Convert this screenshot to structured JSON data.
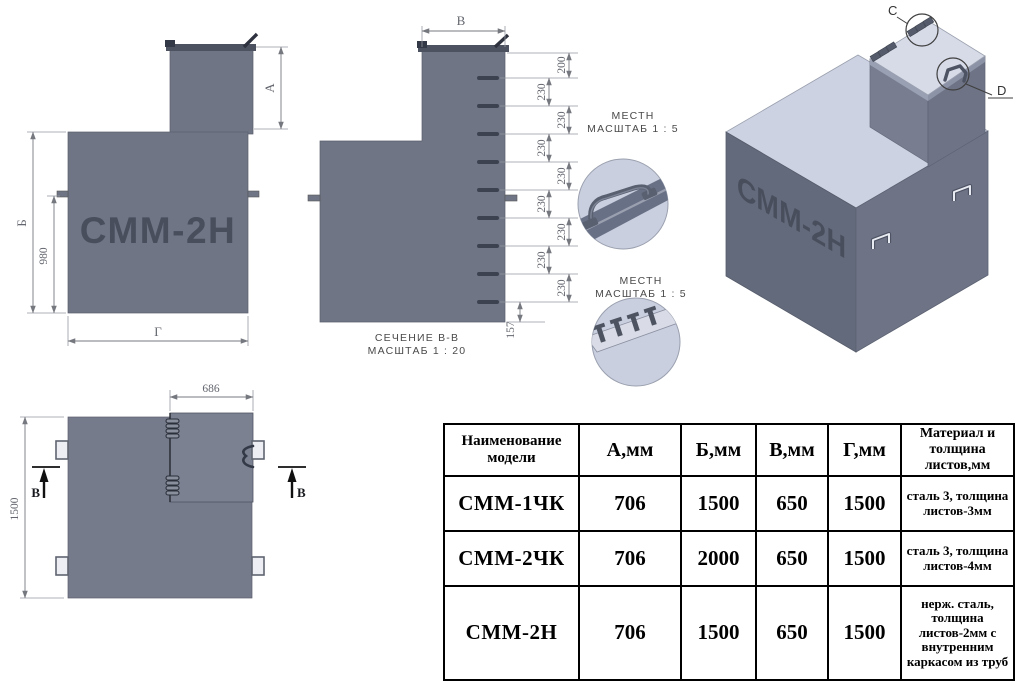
{
  "title": "СММ-2Н technical drawing sheet",
  "colors": {
    "body_slate": "#6f7585",
    "dark_detail": "#474c5a",
    "iso_top": "#cdd2e2",
    "iso_lid": "#d7dbe8",
    "iso_left_face": "#636a7b",
    "iso_right_face": "#6e7486",
    "detail_circle_fill": "#c9cfdf",
    "dim_line": "#75787f",
    "dim_text": "#63666e",
    "caption_text": "#4a4a4a",
    "table_border": "#000000"
  },
  "front_view": {
    "label": "СММ-2Н",
    "dim_a": "А",
    "dim_b": "Б",
    "dim_980": "980",
    "dim_g": "Г"
  },
  "section_view": {
    "dim_v": "В",
    "caption_line1": "СЕЧЕНИЕ В-В",
    "caption_line2": "МАСШТАБ 1 : 20",
    "dims": [
      "200",
      "230",
      "230",
      "230",
      "230",
      "230",
      "230",
      "230",
      "230",
      "157"
    ]
  },
  "details": [
    {
      "line1": "МЕСТН",
      "line2": "МАСШТАБ 1 : 5"
    },
    {
      "line1": "МЕСТН",
      "line2": "МАСШТАБ 1 : 5"
    }
  ],
  "iso_view": {
    "label": "СММ-2Н",
    "callout_c": "C",
    "callout_d": "D"
  },
  "top_view": {
    "dim_686": "686",
    "dim_1500": "1500",
    "section_label": "В"
  },
  "table": {
    "headers": [
      "Наименование модели",
      "А,мм",
      "Б,мм",
      "В,мм",
      "Г,мм",
      "Материал и толщина листов,мм"
    ],
    "rows": [
      {
        "model": "СММ-1ЧК",
        "a": "706",
        "b": "1500",
        "v": "650",
        "g": "1500",
        "material": "сталь 3, толщина листов-3мм"
      },
      {
        "model": "СММ-2ЧК",
        "a": "706",
        "b": "2000",
        "v": "650",
        "g": "1500",
        "material": "сталь 3, толщина листов-4мм"
      },
      {
        "model": "СММ-2Н",
        "a": "706",
        "b": "1500",
        "v": "650",
        "g": "1500",
        "material": "нерж. сталь, толщина листов-2мм с внутренним каркасом из труб"
      }
    ]
  }
}
